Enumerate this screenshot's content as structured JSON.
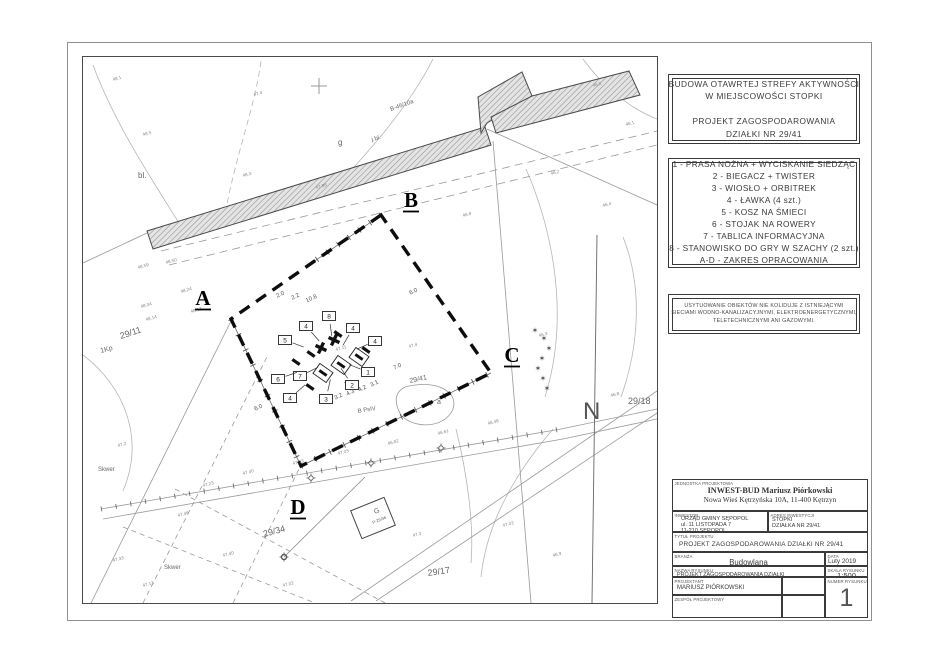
{
  "panel": {
    "title_box": {
      "lines": [
        "BUDOWA OTAWRTEJ STREFY AKTYWNOŚCI",
        "W MIEJSCOWOŚCI STOPKI",
        "",
        "PROJEKT ZAGOSPODAROWANIA",
        "DZIAŁKI NR 29/41"
      ]
    },
    "legend_box": {
      "items": [
        "1 - PRASA NOŻNA + WYCISKANIE SIEDZĄC",
        "2 - BIEGACZ + TWISTER",
        "3 - WIOSŁO + ORBITREK",
        "4 - ŁAWKA (4 szt.)",
        "5 - KOSZ NA ŚMIECI",
        "6 - STOJAK NA ROWERY",
        "7 - TABLICA INFORMACYJNA",
        "8 - STANOWISKO DO GRY W SZACHY (2 szt.)",
        "A-D - ZAKRES OPRACOWANIA"
      ]
    },
    "note_box": {
      "lines": [
        "USYTUOWANIE OBIEKTÓW NIE KOLIDUJE Z ISTNIEJĄCYMI",
        "SIECIAMI WODNO-KANALIZACYJNYMI, ELEKTROENERGETYCZNYMI,",
        "TELETECHNICZNYMI ANI GAZOWYMI."
      ]
    },
    "title_block": {
      "unit_label": "JEDNOSTKA PROJEKTOWA",
      "unit_name": "INWEST-BUD Mariusz Piórkowski",
      "unit_address": "Nowa Wieś Kętrzyńska 10A, 11-400 Kętrzyn",
      "investor_label": "INWESTOR",
      "investor_lines": [
        "URZĄD GMINY SĘPOPOL",
        "ul. 11 LISTOPADA 7",
        "11-210 SĘPOPOL"
      ],
      "address_label": "ADRES INWESTYCJI",
      "address_lines": [
        "STOPKI",
        "DZIAŁKA NR 29/41"
      ],
      "title_label": "TYTUŁ PROJEKTU",
      "title": "PROJEKT ZAGOSPODAROWANIA DZIAŁKI NR 29/41",
      "branch_label": "BRANŻA",
      "branch": "Budowlana",
      "date_label": "DATA",
      "date": "Luty 2019",
      "drawing_label": "NAZWA RYSUNKU",
      "drawing": "PROJEKT ZAGOSPODAROWANIA DZIAŁKI",
      "scale_label": "SKALA RYSUNKU",
      "scale": "1:500",
      "designer_label": "PROJEKTANT",
      "designer": "MARIUSZ PIÓRKOWSKI",
      "team_label": "ZESPÓŁ PROJEKTOWY",
      "number_label": "NUMER RYSUNKU",
      "number": "1"
    }
  },
  "map": {
    "north_label": "N",
    "colors": {
      "boundary": "#0d0d0d",
      "linework": "#999999",
      "contour": "#b5b5b5",
      "label": "#666666"
    },
    "section_letters": [
      {
        "t": "A",
        "x": 120,
        "y": 248
      },
      {
        "t": "B",
        "x": 328,
        "y": 150
      },
      {
        "t": "C",
        "x": 429,
        "y": 305
      },
      {
        "t": "D",
        "x": 215,
        "y": 457
      }
    ],
    "equipment": [
      {
        "n": "8",
        "x": 246,
        "y": 259
      },
      {
        "n": "4",
        "x": 223,
        "y": 269
      },
      {
        "n": "4",
        "x": 270,
        "y": 271
      },
      {
        "n": "5",
        "x": 202,
        "y": 283
      },
      {
        "n": "4",
        "x": 292,
        "y": 284
      },
      {
        "n": "7",
        "x": 217,
        "y": 319
      },
      {
        "n": "6",
        "x": 195,
        "y": 322
      },
      {
        "n": "1",
        "x": 285,
        "y": 315
      },
      {
        "n": "2",
        "x": 269,
        "y": 328
      },
      {
        "n": "3",
        "x": 243,
        "y": 342
      },
      {
        "n": "4",
        "x": 207,
        "y": 341
      }
    ],
    "dimensions": [
      {
        "t": "2.0",
        "x": 198,
        "y": 239,
        "r": -25
      },
      {
        "t": "2.2",
        "x": 213,
        "y": 241,
        "r": -25
      },
      {
        "t": "10.8",
        "x": 229,
        "y": 243,
        "r": -25
      },
      {
        "t": "6.0",
        "x": 331,
        "y": 236,
        "r": -25
      },
      {
        "t": "7.0",
        "x": 315,
        "y": 311,
        "r": -25
      },
      {
        "t": "3.1",
        "x": 292,
        "y": 328,
        "r": -25
      },
      {
        "t": "4.2",
        "x": 280,
        "y": 333,
        "r": -25
      },
      {
        "t": "4.3",
        "x": 268,
        "y": 337,
        "r": -25
      },
      {
        "t": "3.2",
        "x": 256,
        "y": 341,
        "r": -25
      },
      {
        "t": "6.0",
        "x": 176,
        "y": 352,
        "r": -25
      }
    ],
    "labels": [
      {
        "t": "29/11",
        "x": 38,
        "y": 282,
        "r": -18,
        "s": 9
      },
      {
        "t": "29/41",
        "x": 327,
        "y": 326,
        "r": -12,
        "s": 7
      },
      {
        "t": "29/18",
        "x": 545,
        "y": 347,
        "r": 0,
        "s": 9
      },
      {
        "t": "29/34",
        "x": 181,
        "y": 480,
        "r": -15,
        "s": 9
      },
      {
        "t": "29/17",
        "x": 345,
        "y": 519,
        "r": -8,
        "s": 9
      },
      {
        "t": "1Kp",
        "x": 18,
        "y": 296,
        "r": -15,
        "s": 7
      },
      {
        "t": "bl.",
        "x": 55,
        "y": 121,
        "r": 0,
        "s": 8
      },
      {
        "t": "g",
        "x": 255,
        "y": 88,
        "r": 0,
        "s": 8
      },
      {
        "t": "B PsIV",
        "x": 275,
        "y": 356,
        "r": -10,
        "s": 6
      },
      {
        "t": "Skwer",
        "x": 15,
        "y": 414,
        "r": 0,
        "s": 6
      },
      {
        "t": "Skwer",
        "x": 81,
        "y": 512,
        "r": 0,
        "s": 6
      },
      {
        "t": "B-46/10a",
        "x": 308,
        "y": 54,
        "r": -20,
        "s": 6
      },
      {
        "t": "j.bl.",
        "x": 289,
        "y": 84,
        "r": -13,
        "s": 6
      },
      {
        "t": "a",
        "x": 354,
        "y": 347,
        "r": 0,
        "s": 7
      },
      {
        "t": "G",
        "x": 292,
        "y": 457,
        "r": -22,
        "s": 7
      },
      {
        "t": "P-29/36",
        "x": 290,
        "y": 467,
        "r": -22,
        "s": 4.2
      }
    ],
    "spot_elevations": [
      {
        "t": "48.5",
        "x": 60,
        "y": 79
      },
      {
        "t": "47.4",
        "x": 171,
        "y": 39
      },
      {
        "t": "48.1",
        "x": 30,
        "y": 24
      },
      {
        "t": "47.98",
        "x": 233,
        "y": 132
      },
      {
        "t": "48.3",
        "x": 160,
        "y": 120
      },
      {
        "t": "48.59",
        "x": 55,
        "y": 212
      },
      {
        "t": "48.50",
        "x": 83,
        "y": 207
      },
      {
        "t": "48.24",
        "x": 98,
        "y": 236
      },
      {
        "t": "48.34",
        "x": 58,
        "y": 251
      },
      {
        "t": "48.17",
        "x": 108,
        "y": 256
      },
      {
        "t": "48.14",
        "x": 63,
        "y": 264
      },
      {
        "t": "47.11",
        "x": 253,
        "y": 294
      },
      {
        "t": "47.4",
        "x": 326,
        "y": 291
      },
      {
        "t": "46.2",
        "x": 468,
        "y": 118
      },
      {
        "t": "46.1",
        "x": 543,
        "y": 69
      },
      {
        "t": "46.4",
        "x": 520,
        "y": 150
      },
      {
        "t": "46.3",
        "x": 456,
        "y": 280
      },
      {
        "t": "46.8",
        "x": 528,
        "y": 340
      },
      {
        "t": "46.5",
        "x": 510,
        "y": 30
      },
      {
        "t": "46.8",
        "x": 380,
        "y": 160
      },
      {
        "t": "47.23",
        "x": 120,
        "y": 430
      },
      {
        "t": "47.40",
        "x": 160,
        "y": 418
      },
      {
        "t": "47.13",
        "x": 210,
        "y": 408
      },
      {
        "t": "47.03",
        "x": 255,
        "y": 398
      },
      {
        "t": "46.82",
        "x": 305,
        "y": 388
      },
      {
        "t": "46.61",
        "x": 355,
        "y": 378
      },
      {
        "t": "46.48",
        "x": 405,
        "y": 368
      },
      {
        "t": "47.46",
        "x": 95,
        "y": 460
      },
      {
        "t": "47.2",
        "x": 35,
        "y": 390
      },
      {
        "t": "47.40",
        "x": 140,
        "y": 500
      },
      {
        "t": "47.13",
        "x": 60,
        "y": 530
      },
      {
        "t": "47.33",
        "x": 30,
        "y": 505
      },
      {
        "t": "47.02",
        "x": 200,
        "y": 530
      },
      {
        "t": "47.3",
        "x": 330,
        "y": 480
      },
      {
        "t": "47.02",
        "x": 420,
        "y": 470
      },
      {
        "t": "46.9",
        "x": 470,
        "y": 500
      }
    ],
    "trees": [
      {
        "x": 461,
        "y": 284
      },
      {
        "x": 466,
        "y": 294
      },
      {
        "x": 459,
        "y": 304
      },
      {
        "x": 455,
        "y": 314
      },
      {
        "x": 460,
        "y": 324
      },
      {
        "x": 464,
        "y": 334
      },
      {
        "x": 452,
        "y": 276
      }
    ],
    "lamps": [
      {
        "x": 228,
        "y": 421
      },
      {
        "x": 288,
        "y": 406
      },
      {
        "x": 358,
        "y": 391
      },
      {
        "x": 201,
        "y": 500
      }
    ]
  }
}
